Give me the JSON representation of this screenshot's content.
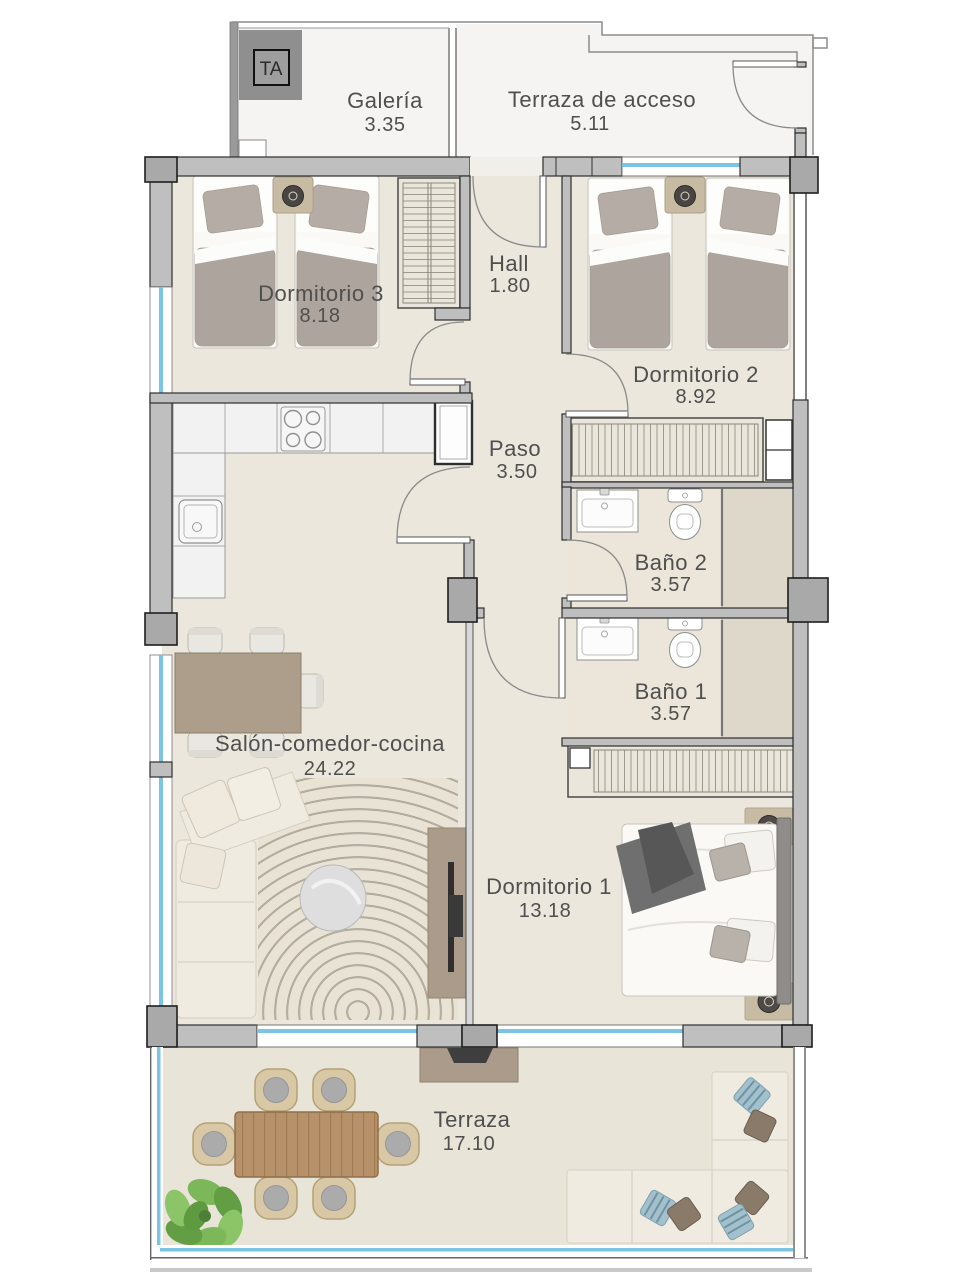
{
  "unit_tag": "TA",
  "rooms": [
    {
      "name": "Galería",
      "area": "3.35"
    },
    {
      "name": "Terraza de acceso",
      "area": "5.11"
    },
    {
      "name": "Dormitorio 3",
      "area": "8.18"
    },
    {
      "name": "Hall",
      "area": "1.80"
    },
    {
      "name": "Dormitorio 2",
      "area": "8.92"
    },
    {
      "name": "Paso",
      "area": "3.50"
    },
    {
      "name": "Baño 2",
      "area": "3.57"
    },
    {
      "name": "Baño 1",
      "area": "3.57"
    },
    {
      "name": "Salón-comedor-cocina",
      "area": "24.22"
    },
    {
      "name": "Dormitorio 1",
      "area": "13.18"
    },
    {
      "name": "Terraza",
      "area": "17.10"
    }
  ],
  "colors": {
    "floor": "#ECE7DD",
    "bath": "#ECE5D9",
    "shower": "#DDD8C9",
    "terrace": "#E9E4D8",
    "outdoor": "#F5F4F2",
    "wall": "#BFBFBF",
    "wallDark": "#A9A9A9",
    "outline": "#2E2E2E",
    "thinline": "#8C8C8C",
    "glass": "#7CC4E4",
    "ink": "#4F4F4F",
    "duvet": "#ADA49D",
    "pillow": "#B5ADA5",
    "bedlinen": "#FAF9F6",
    "tan": "#C8BBA4",
    "counter": "#F2F2F2",
    "wardrobe": "#EAE6DC",
    "stripe": "#9D9A8D",
    "table": "#AD9E8C",
    "chair": "#E9E7E2",
    "sofa": "#F0EBE1",
    "rug": "#E9E3D5",
    "rugline": "#CFC5AE",
    "marble": "#DEDEDE",
    "wood": "#B6916A",
    "woodline": "#A07C52",
    "wicker": "#D8C8A6",
    "cushion": "#ABABAB",
    "plant": "#7CB85A",
    "plantDark": "#639E44",
    "tv": "#AB9B8A",
    "dark": "#3E3E3E",
    "throw": "#6F6F6F"
  }
}
